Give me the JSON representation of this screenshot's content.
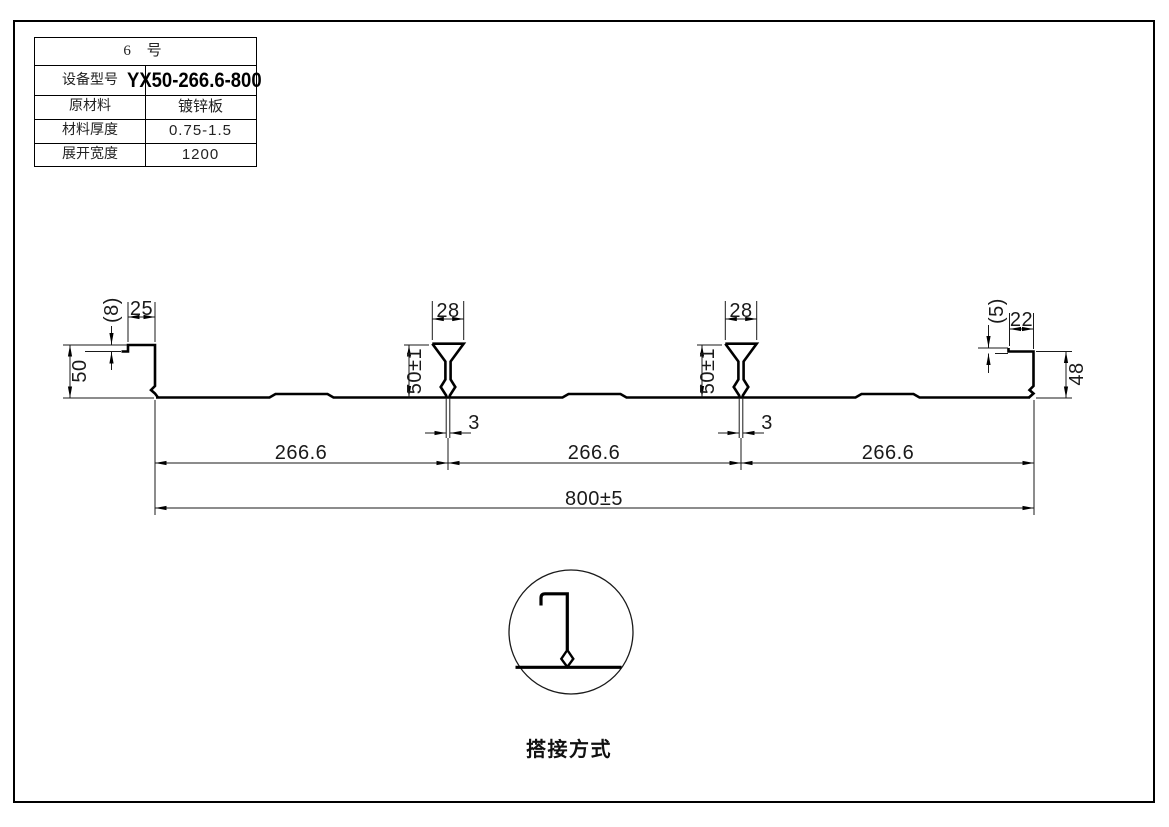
{
  "spec_table": {
    "title": "6 号",
    "rows": [
      {
        "label": "设备型号",
        "value": "YX50-266.6-800"
      },
      {
        "label": "原材料",
        "value": "镀锌板"
      },
      {
        "label": "材料厚度",
        "value": "0.75-1.5"
      },
      {
        "label": "展开宽度",
        "value": "1200"
      }
    ]
  },
  "dimensions": {
    "left_step": "(8)",
    "left_lip_width": "25",
    "left_rib_height": "50",
    "rib1_top_width": "28",
    "rib1_height": "50±1",
    "rib1_slot": "3",
    "rib2_top_width": "28",
    "rib2_height": "50±1",
    "rib2_slot": "3",
    "right_step": "(5)",
    "right_lip_width": "22",
    "right_rib_height": "48",
    "span1": "266.6",
    "span2": "266.6",
    "span3": "266.6",
    "overall_width": "800±5"
  },
  "lap_detail": {
    "caption": "搭接方式"
  },
  "colors": {
    "line": "#000000",
    "background": "#ffffff"
  }
}
